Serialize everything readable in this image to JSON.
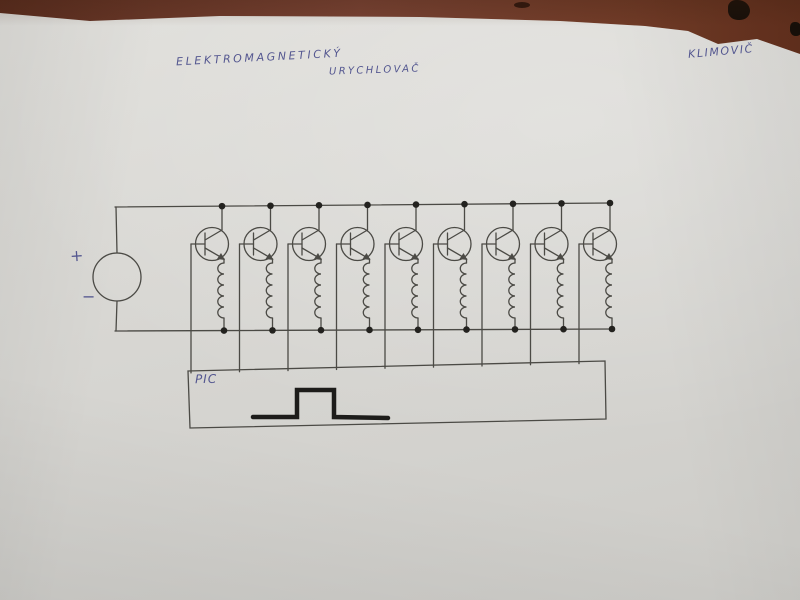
{
  "photo": {
    "title_word1": "ELEKTROMAGNETICKÝ",
    "title_word2": "URYCHLOVAČ",
    "author_signature": "KLIMOVIČ"
  },
  "schematic": {
    "controller_label": "PIC",
    "source_plus_label": "+",
    "source_minus_label": "−",
    "stage_count": 9
  },
  "colors": {
    "desk_brown": "#6f3a26",
    "desk_dark": "#2f170e",
    "paper": "#d9d8d4",
    "ink_blue": "#545790",
    "pencil": "#4b4a45",
    "junction_black": "#23221f",
    "pulse_black": "#1d1c1a"
  }
}
